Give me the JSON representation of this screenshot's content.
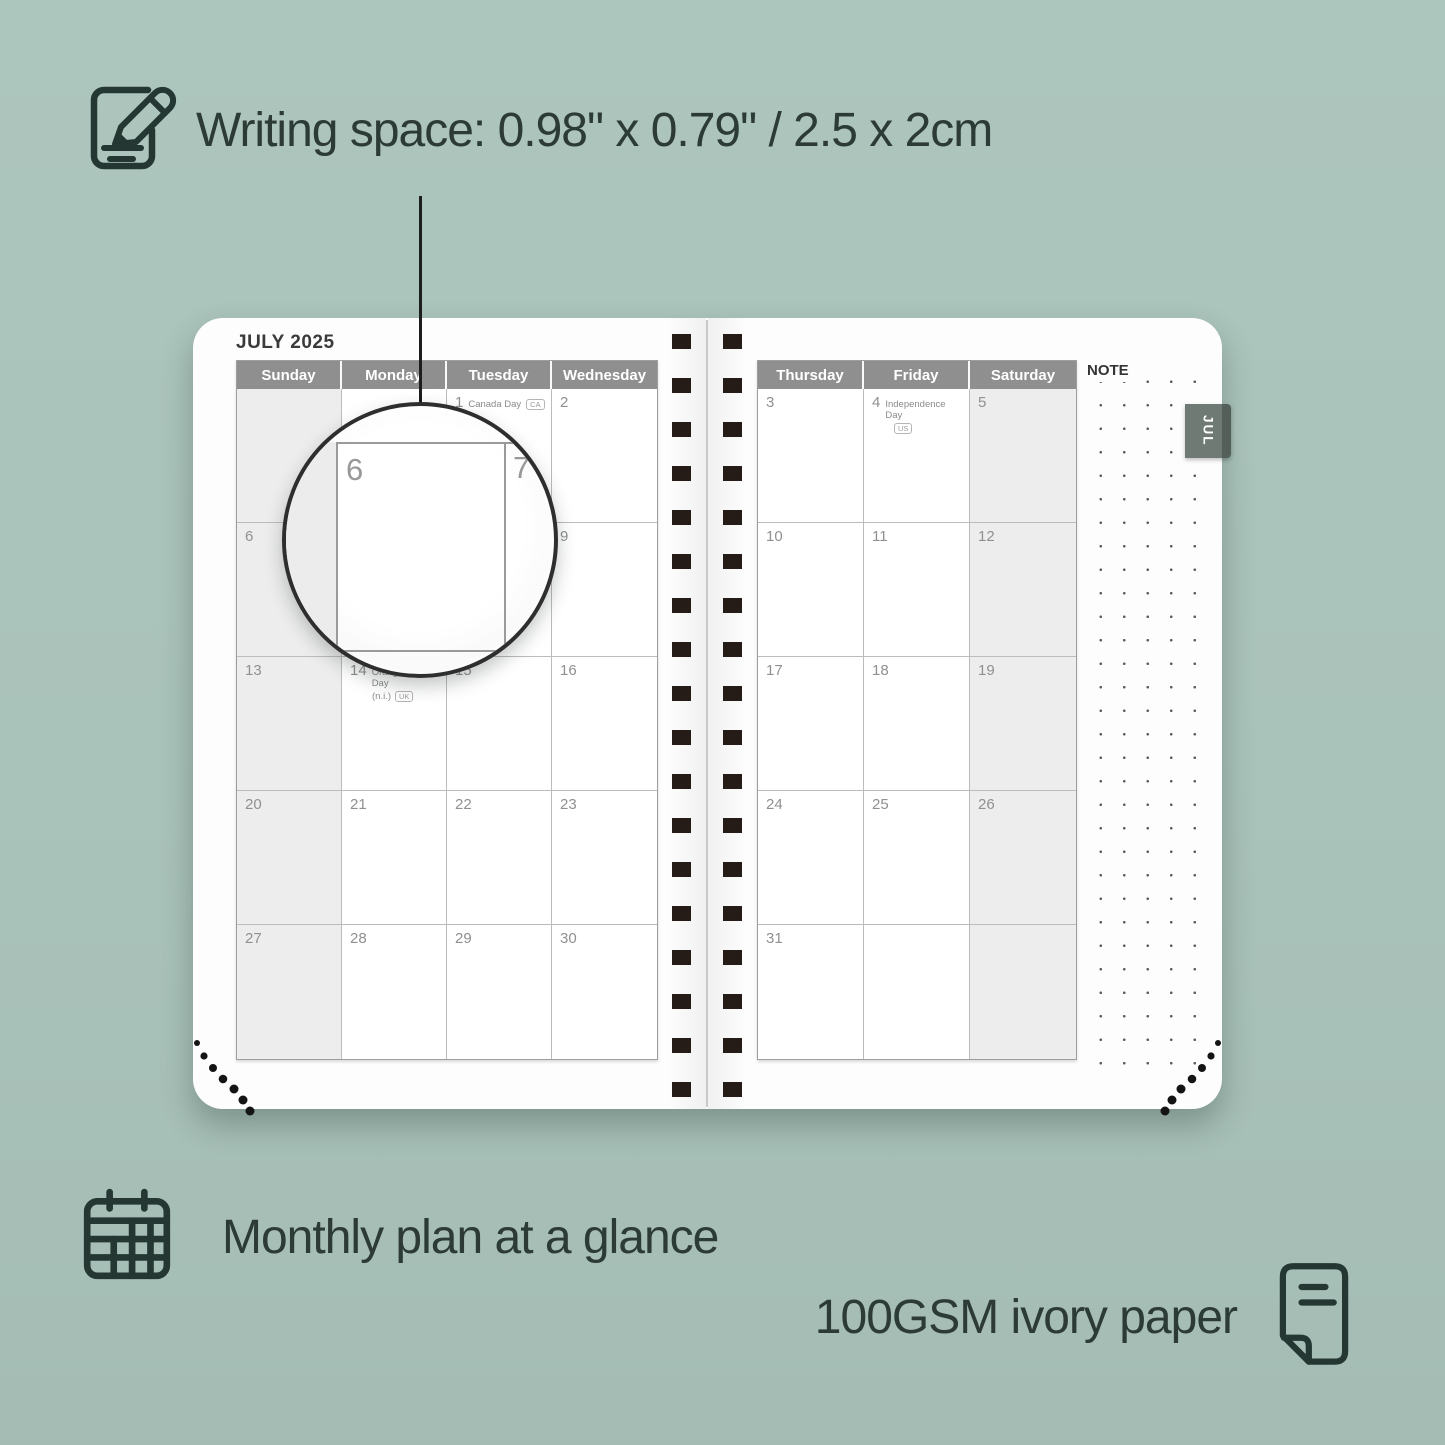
{
  "features": {
    "writing_space": "Writing space: 0.98\" x 0.79\" / 2.5 x 2cm",
    "monthly_plan": "Monthly plan at a glance",
    "paper": "100GSM ivory paper"
  },
  "planner": {
    "month_title": "JULY 2025",
    "tab_label": "JUL",
    "note_label": "NOTE",
    "magnifier": {
      "left_day": "6",
      "right_day": "7"
    },
    "left_page": {
      "day_headers": [
        "Sunday",
        "Monday",
        "Tuesday",
        "Wednesday"
      ],
      "weekend_col": 0,
      "rows": [
        [
          {
            "day": ""
          },
          {
            "day": ""
          },
          {
            "day": "1",
            "holiday": "Canada Day",
            "badge": "CA",
            "badge_pos": "inline"
          },
          {
            "day": "2"
          }
        ],
        [
          {
            "day": "6"
          },
          {
            "day": "7"
          },
          {
            "day": "8"
          },
          {
            "day": "9"
          }
        ],
        [
          {
            "day": "13"
          },
          {
            "day": "14",
            "holiday": "Orangemen's Day",
            "holiday2": "(n.i.)",
            "badge": "UK",
            "badge_pos": "below"
          },
          {
            "day": "15"
          },
          {
            "day": "16"
          }
        ],
        [
          {
            "day": "20"
          },
          {
            "day": "21"
          },
          {
            "day": "22"
          },
          {
            "day": "23"
          }
        ],
        [
          {
            "day": "27"
          },
          {
            "day": "28"
          },
          {
            "day": "29"
          },
          {
            "day": "30"
          }
        ]
      ]
    },
    "right_page": {
      "day_headers": [
        "Thursday",
        "Friday",
        "Saturday"
      ],
      "weekend_col": 2,
      "rows": [
        [
          {
            "day": "3"
          },
          {
            "day": "4",
            "holiday": "Independence Day",
            "badge": "US",
            "badge_pos": "below"
          },
          {
            "day": "5"
          }
        ],
        [
          {
            "day": "10"
          },
          {
            "day": "11"
          },
          {
            "day": "12"
          }
        ],
        [
          {
            "day": "17"
          },
          {
            "day": "18"
          },
          {
            "day": "19"
          }
        ],
        [
          {
            "day": "24"
          },
          {
            "day": "25"
          },
          {
            "day": "26"
          }
        ],
        [
          {
            "day": "31"
          },
          {
            "day": ""
          },
          {
            "day": ""
          }
        ]
      ]
    }
  },
  "colors": {
    "background": "#a9c2ba",
    "text_dark": "#2d3b36",
    "header_gray": "#8f8f8f",
    "weekend_shade": "#ededed",
    "binding_dark": "#261c17",
    "tab_gray_green": "#6f7a74",
    "page_white": "#fdfdfd"
  }
}
